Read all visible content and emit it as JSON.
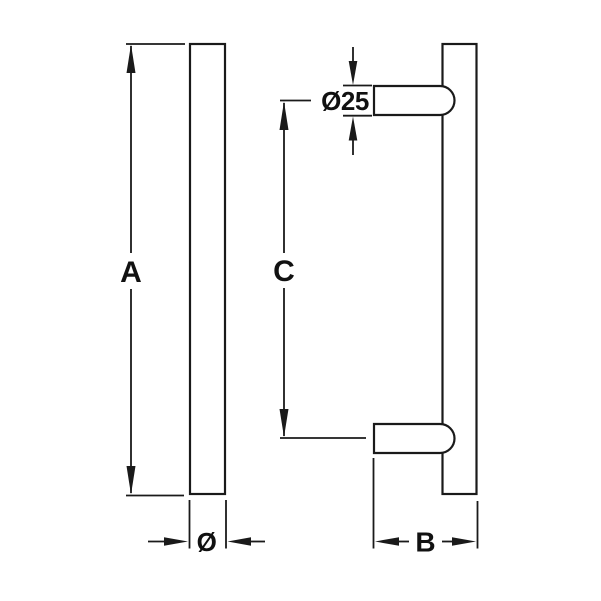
{
  "colors": {
    "background": "#ffffff",
    "line": "#1a1a1a",
    "text": "#111111"
  },
  "drawing": {
    "labels": {
      "length_a": "A",
      "bar_diameter": "Ø",
      "post_diameter": "Ø25",
      "centers_c": "C",
      "projection_b": "B"
    }
  }
}
